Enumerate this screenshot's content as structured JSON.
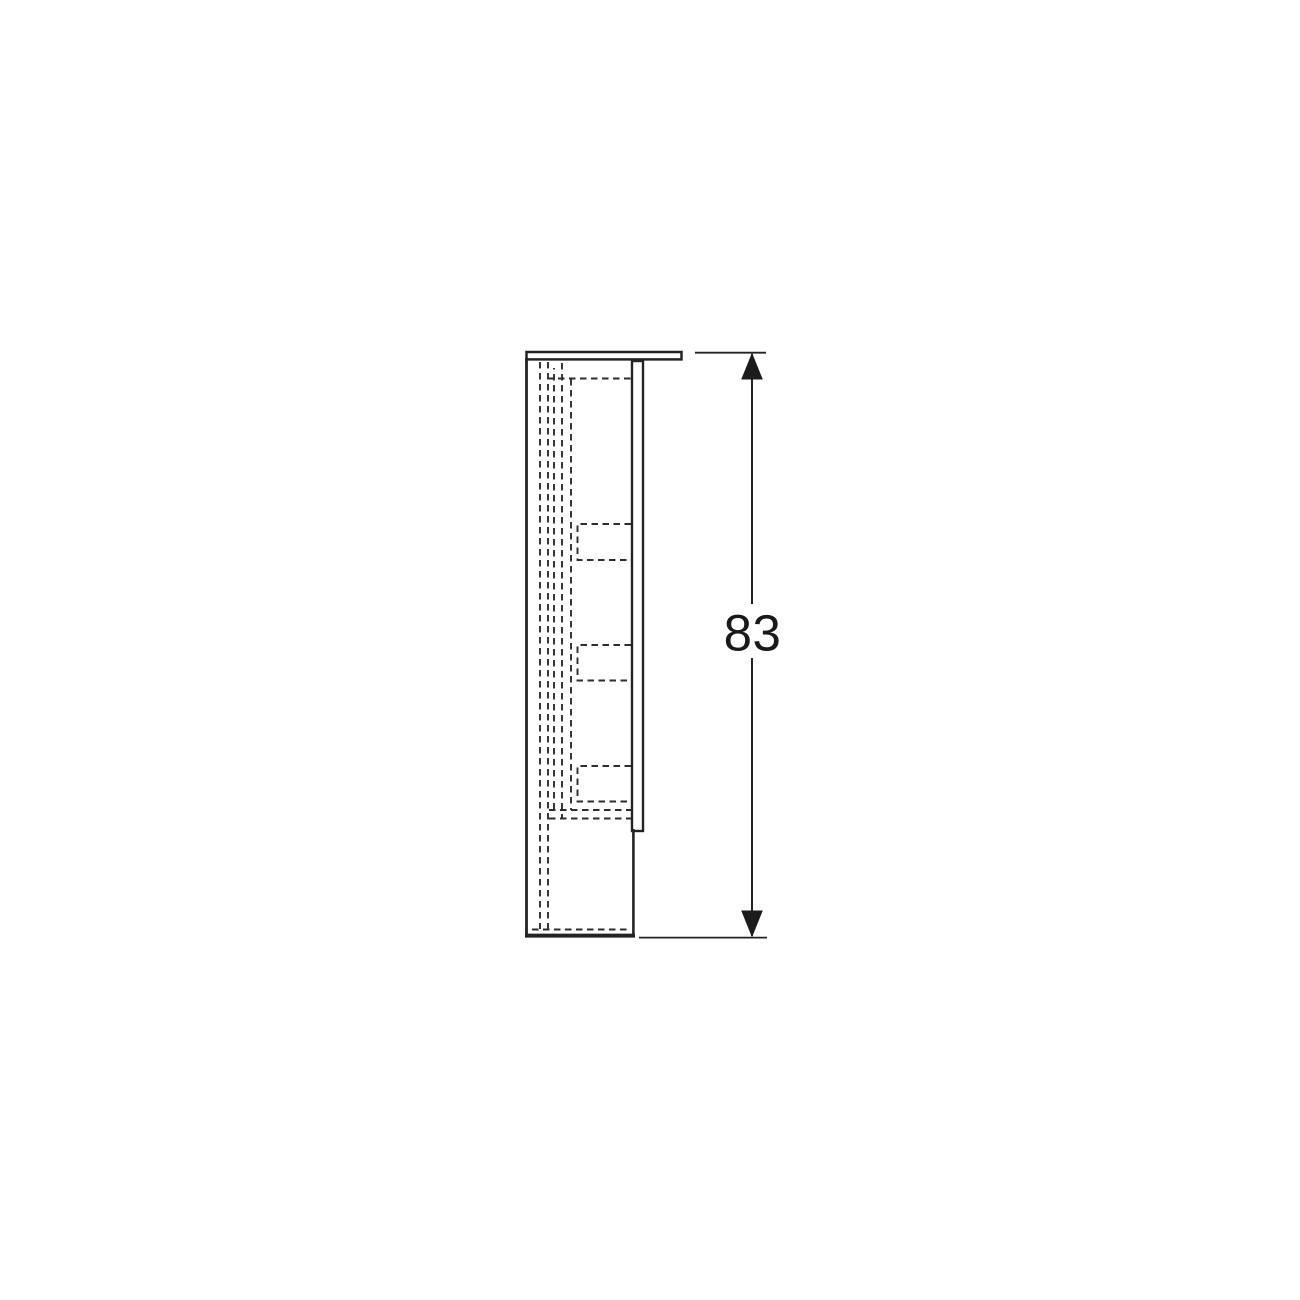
{
  "dimension": {
    "label": "83"
  },
  "colors": {
    "line": "#242424",
    "text": "#1a1a1a",
    "background": "#ffffff"
  }
}
